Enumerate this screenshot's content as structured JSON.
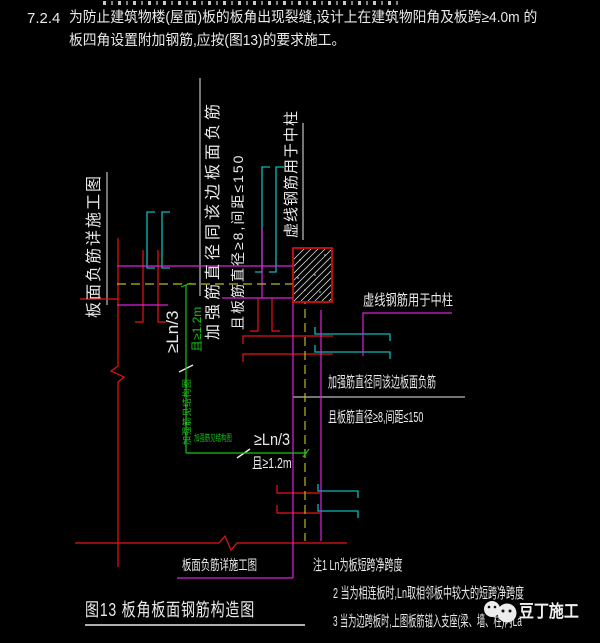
{
  "colors": {
    "background": "#000000",
    "red": "#e81313",
    "magenta": "#dd22dd",
    "cyan": "#12b7b7",
    "yellow": "#b9b913",
    "green": "#16c216",
    "white": "#e9e9e9"
  },
  "header": {
    "section_number": "7.2.4",
    "line1": "为防止建筑物楼(屋面)板的板角出现裂缝,设计上在建筑物阳角及板跨≥4.0m 的",
    "line2": "板四角设置附加钢筋,应按(图13)的要求施工。"
  },
  "diagram": {
    "labels": {
      "left_caption_vertical": "板面负筋详施工图",
      "reinforce_same_dia_vertical": "加强筋直径同该边板面负筋",
      "bar_dia_spacing_vertical": "且板筋直径≥8,间距≤150",
      "dashed_bar_mid_column_vertical": "虚线钢筋用于中柱",
      "dashed_bar_mid_column": "虚线钢筋用于中柱",
      "reinforce_same_dia": "加强筋直径同该边板面负筋",
      "bar_dia_spacing": "且板筋直径≥8,间距≤150",
      "dim_vertical_value": "≥Ln/3",
      "dim_vertical_extra": "且≥1.2m",
      "dim_horizontal_value": "≥Ln/3",
      "dim_horizontal_extra": "且≥1.2m",
      "reinforce_see_structural_vertical": "加强筋见结构图",
      "reinforce_see_structural": "加强筋见结构图",
      "bottom_caption": "板面负筋详施工图"
    },
    "figure_caption": "图13   板角板面钢筋构造图",
    "notes": [
      "注1 Ln为板短跨净跨度",
      "2 当为相连板时,Ln取相邻板中较大的短跨净跨度",
      "3 当为边跨板时,上图板筋锚入支座(梁、墙、柱)内La"
    ]
  },
  "watermark": {
    "text": "豆丁施工"
  }
}
